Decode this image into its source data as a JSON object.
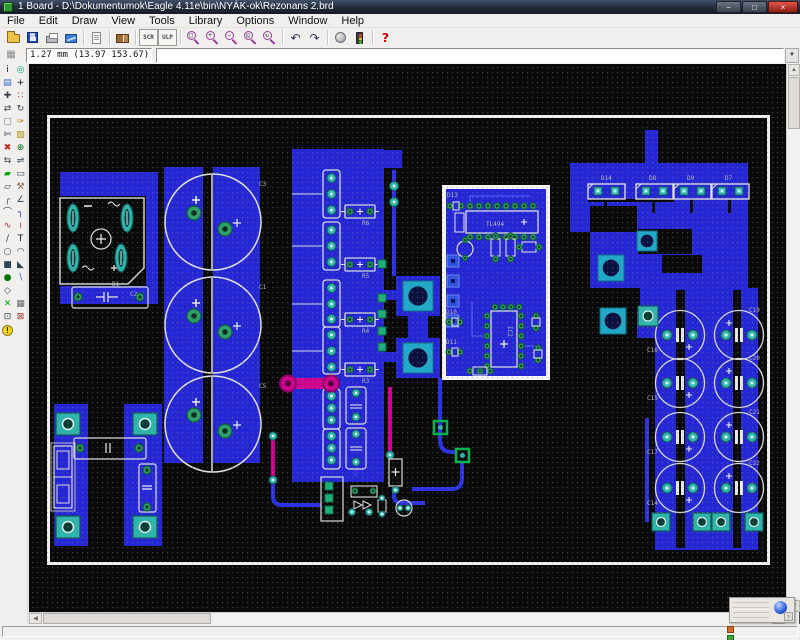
{
  "window": {
    "title": "1 Board - D:\\Dokumentumok\\Eagle 4.11e\\bin\\NYÁK-ok\\Rezonans 2.brd",
    "controls": {
      "minimize": "−",
      "maximize": "□",
      "close": "×"
    }
  },
  "menubar": {
    "items": [
      "File",
      "Edit",
      "Draw",
      "View",
      "Tools",
      "Library",
      "Options",
      "Window",
      "Help"
    ]
  },
  "toolbar": {
    "items": [
      {
        "name": "open-button",
        "kind": "art",
        "art": "folder"
      },
      {
        "name": "save-button",
        "kind": "art",
        "art": "floppy"
      },
      {
        "name": "print-button",
        "kind": "art",
        "art": "printer"
      },
      {
        "name": "cam-processor-button",
        "kind": "art",
        "art": "cam"
      },
      {
        "kind": "sep"
      },
      {
        "name": "run-script-button",
        "kind": "art",
        "art": "page"
      },
      {
        "kind": "sep"
      },
      {
        "name": "library-use-button",
        "kind": "art",
        "art": "book"
      },
      {
        "kind": "sep"
      },
      {
        "name": "script-button",
        "kind": "badge",
        "label": "SCR"
      },
      {
        "name": "ulp-button",
        "kind": "badge",
        "label": "ULP"
      },
      {
        "kind": "sep"
      },
      {
        "name": "zoom-fit-button",
        "kind": "mag",
        "label": "□"
      },
      {
        "name": "zoom-in-button",
        "kind": "mag",
        "label": "+"
      },
      {
        "name": "zoom-out-button",
        "kind": "mag",
        "label": "−"
      },
      {
        "name": "zoom-select-button",
        "kind": "mag",
        "label": "◱"
      },
      {
        "name": "zoom-redraw-button",
        "kind": "mag",
        "label": "↻"
      },
      {
        "kind": "sep"
      },
      {
        "name": "undo-button",
        "kind": "glyph",
        "glyph": "↶",
        "color": "#335"
      },
      {
        "name": "redo-button",
        "kind": "glyph",
        "glyph": "↷",
        "color": "#335"
      },
      {
        "kind": "sep"
      },
      {
        "name": "stop-button",
        "kind": "art",
        "art": "stop"
      },
      {
        "name": "go-button",
        "kind": "art",
        "art": "traffic"
      },
      {
        "kind": "sep"
      },
      {
        "name": "help-button",
        "kind": "glyph",
        "glyph": "?",
        "color": "#c00"
      }
    ]
  },
  "coordbar": {
    "coordinate": "1.27 mm (13.97 153.67)",
    "command_value": ""
  },
  "icons": {
    "dropdown": "▼",
    "up": "▲",
    "down": "▼",
    "left": "◀",
    "right": "▶",
    "grid": "▦",
    "widget_more": "›"
  },
  "palette": {
    "items": [
      {
        "name": "info-tool",
        "glyph": "i",
        "color": "#111"
      },
      {
        "name": "show-tool",
        "glyph": "◎",
        "color": "#0a8"
      },
      {
        "name": "display-tool",
        "glyph": "▤",
        "color": "#36c"
      },
      {
        "name": "mark-tool",
        "glyph": "+",
        "color": "#111"
      },
      {
        "name": "move-tool",
        "glyph": "✚",
        "color": "#345"
      },
      {
        "name": "copy-tool",
        "glyph": "∷",
        "color": "#a33"
      },
      {
        "name": "mirror-tool",
        "glyph": "⇄",
        "color": "#345"
      },
      {
        "name": "rotate-tool",
        "glyph": "↻",
        "color": "#345"
      },
      {
        "name": "group-tool",
        "glyph": "▢",
        "color": "#777"
      },
      {
        "name": "change-tool",
        "glyph": "✑",
        "color": "#b80"
      },
      {
        "name": "cut-tool",
        "glyph": "✄",
        "color": "#345"
      },
      {
        "name": "paste-tool",
        "glyph": "▨",
        "color": "#b89000"
      },
      {
        "name": "delete-tool",
        "glyph": "✖",
        "color": "#c22"
      },
      {
        "name": "add-tool",
        "glyph": "⊕",
        "color": "#171"
      },
      {
        "name": "pinswap-tool",
        "glyph": "⇆",
        "color": "#345"
      },
      {
        "name": "gateswap-tool",
        "glyph": "⇌",
        "color": "#345"
      },
      {
        "name": "lock-tool",
        "glyph": "▰",
        "color": "#0a0"
      },
      {
        "name": "name-tool",
        "glyph": "▭",
        "color": "#345"
      },
      {
        "name": "value-tool",
        "glyph": "▱",
        "color": "#345"
      },
      {
        "name": "smash-tool",
        "glyph": "⚒",
        "color": "#864"
      },
      {
        "name": "miter-tool",
        "glyph": "╭",
        "color": "#345"
      },
      {
        "name": "split-tool",
        "glyph": "∠",
        "color": "#345"
      },
      {
        "name": "optimize-tool",
        "glyph": "⌒",
        "color": "#345"
      },
      {
        "name": "route-tool",
        "glyph": "┐",
        "color": "#22c"
      },
      {
        "name": "ripup-tool",
        "glyph": "∿",
        "color": "#c22"
      },
      {
        "name": "meander-tool",
        "glyph": "≀",
        "color": "#c22"
      },
      {
        "name": "wire-tool",
        "glyph": "∕",
        "color": "#345"
      },
      {
        "name": "text-tool",
        "glyph": "T",
        "color": "#111"
      },
      {
        "name": "circle-tool",
        "glyph": "○",
        "color": "#345"
      },
      {
        "name": "arc-tool",
        "glyph": "◠",
        "color": "#345"
      },
      {
        "name": "rect-tool",
        "glyph": "■",
        "color": "#345"
      },
      {
        "name": "polygon-tool",
        "glyph": "◣",
        "color": "#345"
      },
      {
        "name": "via-tool",
        "glyph": "●",
        "color": "#070"
      },
      {
        "name": "signal-tool",
        "glyph": "∖",
        "color": "#26c"
      },
      {
        "name": "hole-tool",
        "glyph": "◇",
        "color": "#345"
      },
      {
        "name": "spacer",
        "glyph": "",
        "color": "#345"
      },
      {
        "name": "ratsnest-tool",
        "glyph": "✕",
        "color": "#0a0"
      },
      {
        "name": "auto-tool",
        "glyph": "▦",
        "color": "#666"
      },
      {
        "name": "drc-tool",
        "glyph": "⊡",
        "color": "#345"
      },
      {
        "name": "errors-tool",
        "glyph": "⊠",
        "color": "#a33"
      },
      {
        "name": "warning-tool",
        "glyph": "!",
        "special": "warn",
        "color": "#222"
      }
    ]
  },
  "pcb": {
    "resistors": [
      "R6",
      "R5",
      "R4",
      "R3"
    ],
    "big_caps": [
      "C3",
      "C1",
      "C5"
    ],
    "top_diodes": [
      "D14",
      "D8",
      "D9",
      "D7"
    ],
    "right_caps_left": [
      "C16",
      "C15",
      "C17",
      "C14"
    ],
    "right_caps_right": [
      "C19",
      "C20",
      "C21",
      "C22"
    ],
    "bridge_area": {
      "d1": "D1",
      "c2": "C2"
    },
    "module": {
      "d13": "D13",
      "ic1": "TL494",
      "d10": "D10",
      "d11": "D11",
      "ic2": "IC2"
    }
  }
}
